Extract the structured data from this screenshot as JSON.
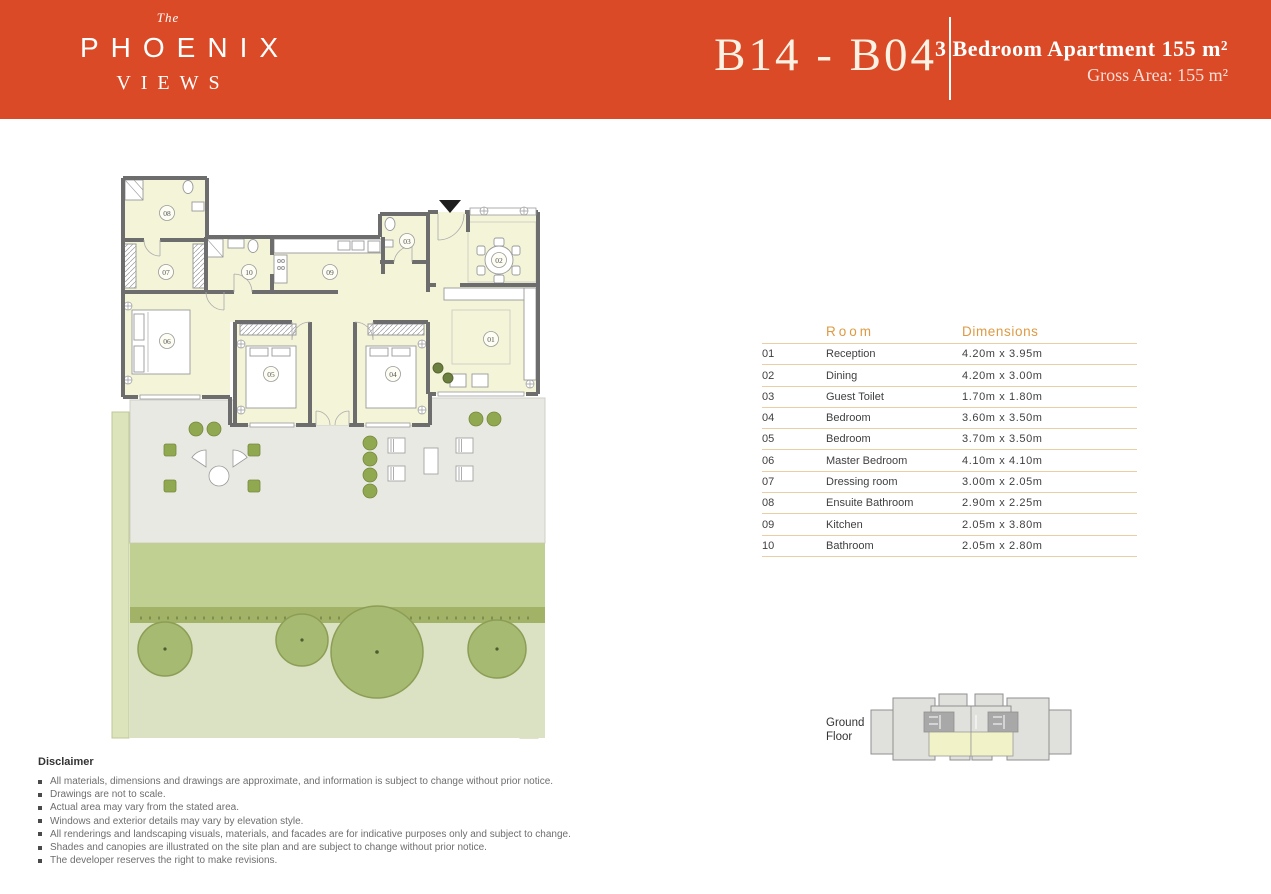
{
  "header": {
    "brand_the": "The",
    "brand_name": "PHOENIX",
    "brand_sub": "VIEWS",
    "unit_code": "B14 - B04",
    "title": "3 Bedroom Apartment 155 m²",
    "subtitle": "Gross Area: 155 m²",
    "bg_color": "#DB4A26"
  },
  "table": {
    "headers": {
      "room": "Room",
      "dimensions": "Dimensions"
    },
    "accent_color": "#DE9A43",
    "line_color": "#EACEA4",
    "rows": [
      {
        "no": "01",
        "room": "Reception",
        "dims": "4.20m x 3.95m"
      },
      {
        "no": "02",
        "room": "Dining",
        "dims": "4.20m x 3.00m"
      },
      {
        "no": "03",
        "room": "Guest Toilet",
        "dims": "1.70m x 1.80m"
      },
      {
        "no": "04",
        "room": "Bedroom",
        "dims": "3.60m x 3.50m"
      },
      {
        "no": "05",
        "room": "Bedroom",
        "dims": "3.70m x 3.50m"
      },
      {
        "no": "06",
        "room": "Master Bedroom",
        "dims": "4.10m x 4.10m"
      },
      {
        "no": "07",
        "room": "Dressing room",
        "dims": "3.00m x 2.05m"
      },
      {
        "no": "08",
        "room": "Ensuite Bathroom",
        "dims": "2.90m x 2.25m"
      },
      {
        "no": "09",
        "room": "Kitchen",
        "dims": "2.05m x 3.80m"
      },
      {
        "no": "10",
        "room": "Bathroom",
        "dims": "2.05m x 2.80m"
      }
    ]
  },
  "floor_plan": {
    "labels": [
      "01",
      "02",
      "03",
      "04",
      "05",
      "06",
      "07",
      "08",
      "09",
      "10"
    ],
    "room_fill": "#F4F4D9",
    "wall_color": "#6D6D6D",
    "lawn_color": "#C0CF92",
    "tree_color": "#A7BA72",
    "terrace_color": "#E9E9E3"
  },
  "key_plan": {
    "label_line1": "Ground",
    "label_line2": "Floor",
    "highlight_color": "#F2F2C8"
  },
  "disclaimer": {
    "title": "Disclaimer",
    "items": [
      "All materials, dimensions and drawings are approximate, and information is subject to change without prior notice.",
      "Drawings are not to scale.",
      "Actual area may vary from the stated area.",
      "Windows and exterior details may vary by elevation style.",
      "All renderings and landscaping visuals, materials, and facades are for indicative purposes only and subject to change.",
      "Shades and canopies are illustrated on the site plan and are subject to change without prior notice.",
      "The developer reserves the right to make revisions."
    ]
  }
}
